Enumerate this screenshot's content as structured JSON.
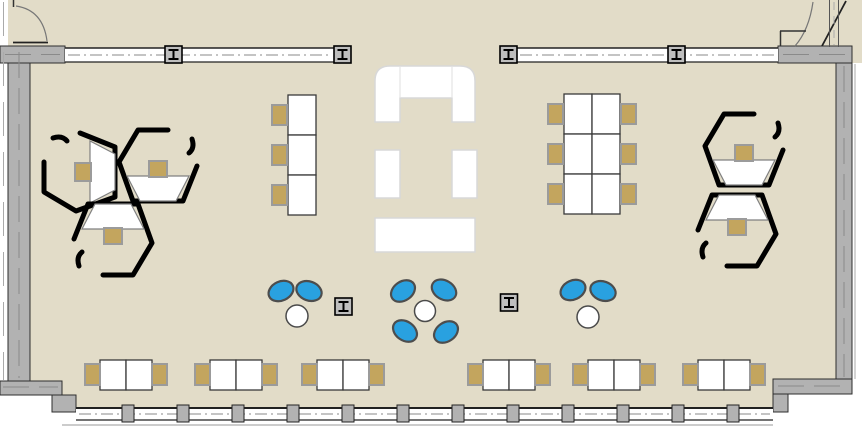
{
  "title": "open-plan-studio-floor-plan",
  "colors": {
    "outside": "#ffffff",
    "floor": "#e2dcc8",
    "wall_fill": "#b2b2b2",
    "wall_edge": "#2e2e2e",
    "wall_centerline": "#8a8a8a",
    "window_white": "#ffffff",
    "window_line": "#888888",
    "desk_white": "#ffffff",
    "desk_edge": "#3a3a3a",
    "chair_tan": "#c3a55e",
    "chair_tan_edge": "#9b9b9b",
    "chair_blue": "#29a1e0",
    "chair_blue_edge": "#4d4d4d",
    "table_white": "#ffffff",
    "table_edge": "#4a4a4a",
    "pod_outline": "#000000",
    "pod_desk_edge": "#808080",
    "sofa_white": "#ffffff",
    "sofa_edge": "#d8d8d8",
    "door_arc": "#777777",
    "door_leaf": "#222222",
    "column_fill": "#bebebe",
    "column_glyph": "#000000"
  },
  "floorplan": {
    "canvas": {
      "w": 862,
      "h": 442
    },
    "floor_rects": [
      {
        "x": 8,
        "y": 0,
        "w": 854,
        "h": 63
      },
      {
        "x": 8,
        "y": 0,
        "w": 844,
        "h": 408
      }
    ],
    "outside_cutouts": [
      {
        "x": 0,
        "y": 395,
        "w": 52,
        "h": 47
      },
      {
        "x": 788,
        "y": 394,
        "w": 74,
        "h": 48
      }
    ],
    "walls": [
      {
        "name": "left-wall",
        "x": 8,
        "y": 46,
        "w": 22,
        "h": 336
      },
      {
        "name": "top-left-wall-block",
        "x": 0,
        "y": 46,
        "w": 65,
        "h": 17
      },
      {
        "name": "top-right-wall-block",
        "x": 778,
        "y": 46,
        "w": 74,
        "h": 17
      },
      {
        "name": "right-wall",
        "x": 836,
        "y": 63,
        "w": 16,
        "h": 317
      },
      {
        "name": "bottom-left-wall-band",
        "x": 0,
        "y": 381,
        "w": 62,
        "h": 14
      },
      {
        "name": "bottom-left-wall-step",
        "x": 52,
        "y": 395,
        "w": 24,
        "h": 17
      },
      {
        "name": "bottom-right-wall-band",
        "x": 773,
        "y": 379,
        "w": 79,
        "h": 15
      },
      {
        "name": "bottom-right-wall-step",
        "x": 773,
        "y": 394,
        "w": 15,
        "h": 18
      }
    ],
    "wall_centerlines": [
      [
        19,
        52,
        19,
        378
      ],
      [
        844,
        66,
        844,
        377
      ],
      [
        5,
        54.5,
        60,
        54.5
      ],
      [
        783,
        54.5,
        848,
        54.5
      ],
      [
        3,
        387,
        58,
        387
      ],
      [
        778,
        386,
        848,
        386
      ]
    ],
    "outer_glazing_lines": [
      {
        "x1": 3.5,
        "y1": 2,
        "x2": 3.5,
        "y2": 380,
        "dash": "34 16",
        "color": "#aaaaaa"
      },
      {
        "x1": 855,
        "y1": 64,
        "x2": 855,
        "y2": 379,
        "dash": "",
        "color": "#aaaaaa"
      }
    ],
    "top_window_strips": [
      {
        "x": 65,
        "y": 48,
        "w": 269,
        "h": 14
      },
      {
        "x": 517,
        "y": 48,
        "w": 261,
        "h": 14
      }
    ],
    "bottom_window_strip": {
      "x": 76,
      "y": 408,
      "w": 697,
      "h": 12
    },
    "bottom_outer_line": [
      62,
      425,
      773,
      425
    ],
    "mullion_posts": {
      "y": 405,
      "w": 12,
      "h": 17,
      "xs": [
        128,
        183,
        238,
        293,
        348,
        403,
        458,
        513,
        568,
        623,
        678,
        733
      ]
    },
    "steel_columns": {
      "size": 17,
      "symbol": "I-beam",
      "in_wall": [
        [
          173.5,
          54.5
        ],
        [
          342.5,
          54.5
        ],
        [
          508.5,
          54.5
        ],
        [
          676.5,
          54.5
        ]
      ],
      "in_floor": [
        [
          343.5,
          306.5
        ],
        [
          509,
          302.5
        ]
      ]
    },
    "doors": {
      "arcs": [
        "M 16,6 Q 43,10 47,41",
        "M 813,2 Q 809,30 795,46"
      ],
      "leaves": [
        [
          13,
          42.5,
          48,
          42.5
        ],
        [
          846,
          1,
          822,
          46
        ]
      ],
      "jambs": [
        [
          13.5,
          0,
          13.5,
          7
        ],
        [
          780,
          31,
          806,
          31
        ],
        [
          780.5,
          31,
          780.5,
          46
        ]
      ],
      "vestibule_wall_lines": [
        [
          829.5,
          0,
          829.5,
          47
        ],
        [
          838.5,
          0,
          838.5,
          47
        ]
      ],
      "vestibule_dash": {
        "x": 834,
        "y1": 2,
        "y2": 45
      }
    },
    "pod_shape": {
      "hex_path": "M 10,-44 L -20,-44 L -39,-12 L -25,27 L 25,27 L 39,-8",
      "hook_path": "M 31,-21 Q 37,-26 34,-35",
      "desk_points": "-31,2 31,2 18,27 -18,27",
      "chair": {
        "x": -9,
        "y": -13,
        "w": 18,
        "h": 16
      }
    },
    "pods": [
      {
        "cx": 88,
        "cy": 172,
        "rot": -90
      },
      {
        "cx": 158,
        "cy": 174,
        "rot": 0
      },
      {
        "cx": 113,
        "cy": 231,
        "rot": 180
      },
      {
        "cx": 744,
        "cy": 158,
        "rot": 0
      },
      {
        "cx": 737,
        "cy": 222,
        "rot": 180
      }
    ],
    "desk_runs": [
      {
        "name": "desk-run-left",
        "x": 288,
        "y": 95,
        "cols": 1,
        "rows": 3,
        "cw": 28,
        "rh": 40,
        "chairs": "left"
      },
      {
        "name": "desk-run-right",
        "x": 564,
        "y": 94,
        "cols": 2,
        "rows": 3,
        "cw": 28,
        "rh": 40,
        "chairs": "both"
      }
    ],
    "run_chair": {
      "w": 15,
      "h": 20
    },
    "bottom_desk_pairs": {
      "y": 360,
      "dw": 26,
      "dh": 30,
      "xs": [
        100,
        210,
        317,
        483,
        588,
        698
      ],
      "chair": {
        "w": 15,
        "h": 21,
        "dy": 4
      }
    },
    "lounge_groups": [
      {
        "table": {
          "cx": 297,
          "cy": 316,
          "r": 11
        },
        "chairs": [
          {
            "cx": 281,
            "cy": 291,
            "rot": -25
          },
          {
            "cx": 309,
            "cy": 291,
            "rot": 20
          }
        ]
      },
      {
        "table": {
          "cx": 425,
          "cy": 311,
          "r": 10.5
        },
        "chairs": [
          {
            "cx": 403,
            "cy": 291,
            "rot": -35
          },
          {
            "cx": 444,
            "cy": 290,
            "rot": 30
          },
          {
            "cx": 405,
            "cy": 331,
            "rot": -145
          },
          {
            "cx": 446,
            "cy": 332,
            "rot": 145
          }
        ]
      },
      {
        "table": {
          "cx": 588,
          "cy": 317,
          "r": 11
        },
        "chairs": [
          {
            "cx": 573,
            "cy": 290,
            "rot": -25
          },
          {
            "cx": 603,
            "cy": 291,
            "rot": 20
          }
        ]
      }
    ],
    "blue_chair": {
      "rx": 13,
      "ry": 9.5
    },
    "sofa": {
      "path": "M 375,122 L 375,81 Q 375,66 390,66 L 460,66 Q 475,66 475,81 L 475,122 L 452,122 L 452,98 L 400,98 L 400,122 Z",
      "seams": [
        [
          400,
          67,
          400,
          97
        ],
        [
          452,
          67,
          452,
          97
        ]
      ]
    },
    "benches": [
      {
        "x": 375,
        "y": 150,
        "w": 25,
        "h": 48
      },
      {
        "x": 452,
        "y": 150,
        "w": 25,
        "h": 48
      },
      {
        "x": 375,
        "y": 218,
        "w": 100,
        "h": 34
      }
    ]
  }
}
